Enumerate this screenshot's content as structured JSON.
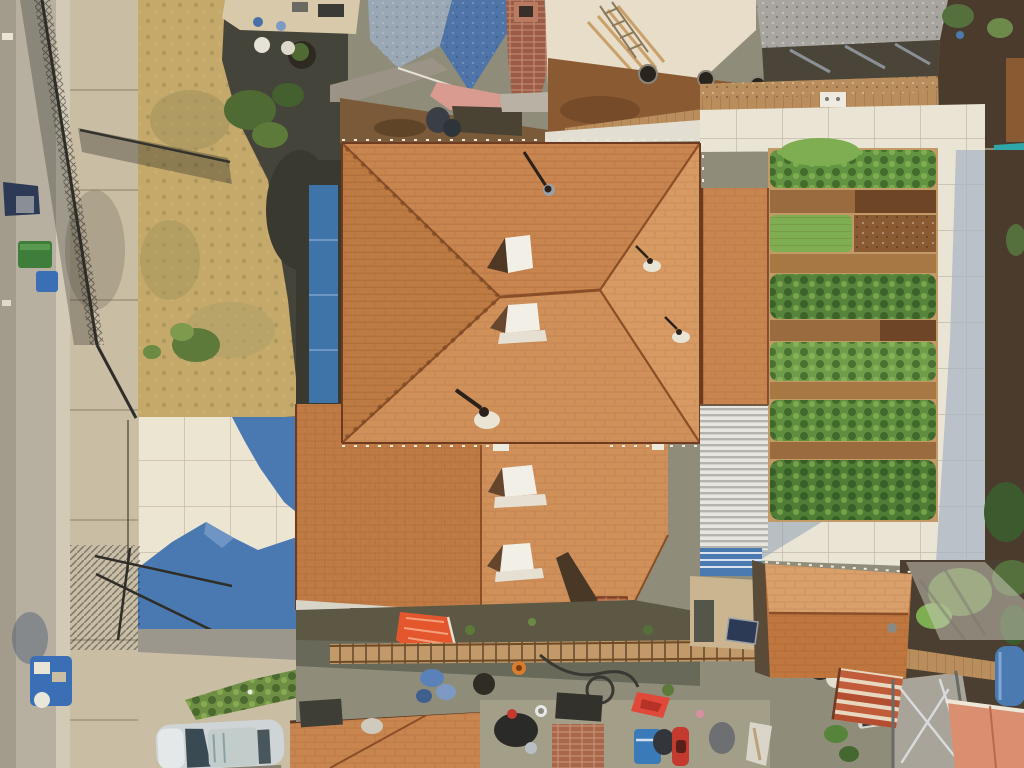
{
  "meta": {
    "type": "aerial-drone-photo",
    "description": "Overhead drone view of a residential lot: large orange shingle hip roof house in center, vegetable garden with planted rows on the right, white paver driveway with blue roof shadow lower left, street and chain-link fence along the left edge, neighboring houses with blue-gray and gray roofs at top, cluttered back alley and a second small orange roof at bottom right."
  },
  "scene": {
    "items": [
      "street with curb and sidewalk",
      "chain-link fence and open gate with shadows",
      "dry grass front yard with shrubs",
      "shaded neighbor yard with round planter",
      "neighbor house with blue-gray shingle roof and brick chimney",
      "neighbor house with gray roof and wood fence",
      "vegetable garden rows framed by white pavers",
      "teal tarp",
      "main house orange shingle hip roof with white vents and pipes",
      "blue panel strip along house side",
      "white corrugated patio roof",
      "white paver driveway with blue roof shadow",
      "trash bins and cart on street",
      "silver car parked at bottom left",
      "green hedge row",
      "back alley with ladder, awning, chimney, chairs, cooler, scooter",
      "secondary orange hip roof with terracotta tiles",
      "blue barrel, salmon stucco wall, metal frame, trees"
    ],
    "palette": {
      "street": "#b7af9f",
      "street_edge": "#a39b8c",
      "gutter": "#d2cab6",
      "sidewalk": "#c9bda3",
      "dry_grass": "#c4a96b",
      "grass_patch": "#a3955c",
      "shade_yard": "#45443a",
      "patio_tan": "#d8c9ab",
      "blue_roof": "#4e74a8",
      "blue_roof_light": "#9aa7b4",
      "chimney_brick": "#9c5b45",
      "wall_pink": "#d99a8f",
      "wall_cream": "#e7ddc8",
      "dirt_brown": "#8a5a33",
      "dirt_brown_dark": "#6e4526",
      "wood_fence": "#b98d5c",
      "gray_roof": "#a8a5a0",
      "dark_band": "#4a4439",
      "paver": "#e9e4d4",
      "paver_shade": "#aab6c4",
      "garden_dirt": "#c29a66",
      "garden_dirt_row": "#9a6b3f",
      "garden_green": "#5f8f3e",
      "garden_green_light": "#7fae52",
      "far_dirt": "#4a3b2c",
      "teal_tarp": "#2fa6a8",
      "roof_orange": "#c9854f",
      "roof_orange_light": "#d79a62",
      "roof_orange_south": "#d0905a",
      "roof_west": "#bd7a43",
      "roof_lower_left": "#c07a44",
      "ridge_brown": "#8a4f28",
      "blue_panel": "#3f74a8",
      "corrugated": "#e8e6e0",
      "driveway": "#ece5d2",
      "shadow_blue": "#4a79b1",
      "hedge_green": "#6f8f45",
      "car_silver": "#cfd4d6",
      "car_glass": "#3a4a52",
      "alley": "#8f8d7a",
      "alley_dark": "#55564a",
      "alley_warm": "#a8a28c",
      "awning_orange": "#e4572e",
      "ladder_wood": "#c29a6a",
      "chimney_red": "#a0522d",
      "adu_upper": "#d9a06b",
      "adu_lower": "#c0763f",
      "terracotta": "#c05c3a",
      "salmon_wall": "#d98f70",
      "barrel_blue": "#4a7ab0",
      "tree_green": "#3d5a2f",
      "tree_green_light": "#6d8a4a",
      "navy": "#2d3a55",
      "cooler_blue": "#3a7ab8",
      "chair_red": "#e0483a",
      "scooter_red": "#c43a2f",
      "frame_gray": "#d9dadc",
      "ground_gray": "#a9a499",
      "wall_light": "#d9d4c8"
    }
  }
}
